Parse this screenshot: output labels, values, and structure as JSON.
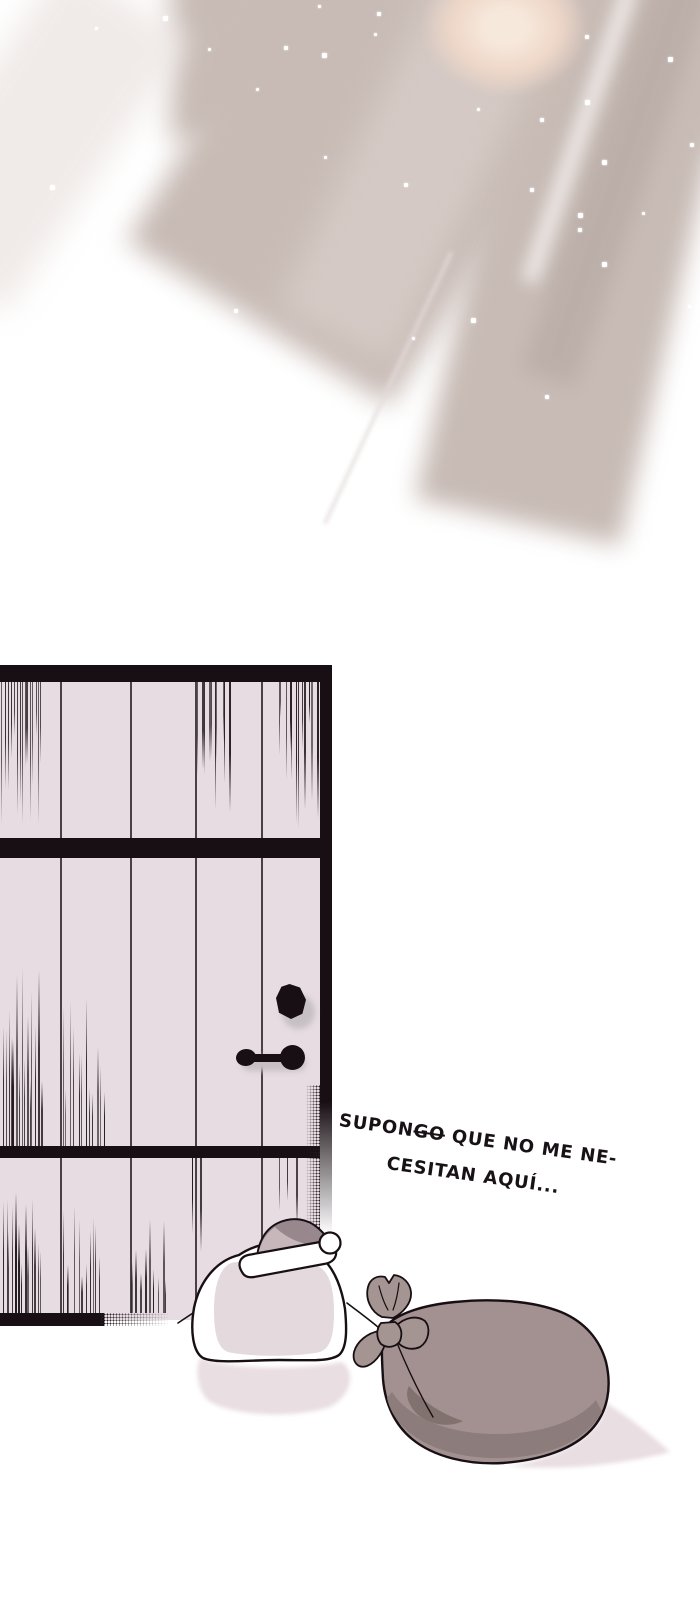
{
  "dialogue": {
    "line1_prefix": "SUPON",
    "line1_struck": "GO",
    "line1_rest": " QUE NO ME NE-",
    "line2": "CESITAN AQUÍ..."
  },
  "colors": {
    "door-fill": "#e7dce1",
    "line": "#170f13",
    "ray": "#c8bbb5",
    "ray-dark": "#b9aca7",
    "peach": "#eed7c8",
    "peach-core": "#f6e8db",
    "sack": "#a29190",
    "sack-shade": "#8c7c7c",
    "sack-dark": "#82726f",
    "bow": "#a49492",
    "bag-inner": "#e4dadd",
    "hat-dark": "#98878c",
    "hat-light": "#c7b7bb",
    "shadow": "#e9dee2",
    "text": "#181115",
    "knob-shadow": "#c6bfc3"
  }
}
